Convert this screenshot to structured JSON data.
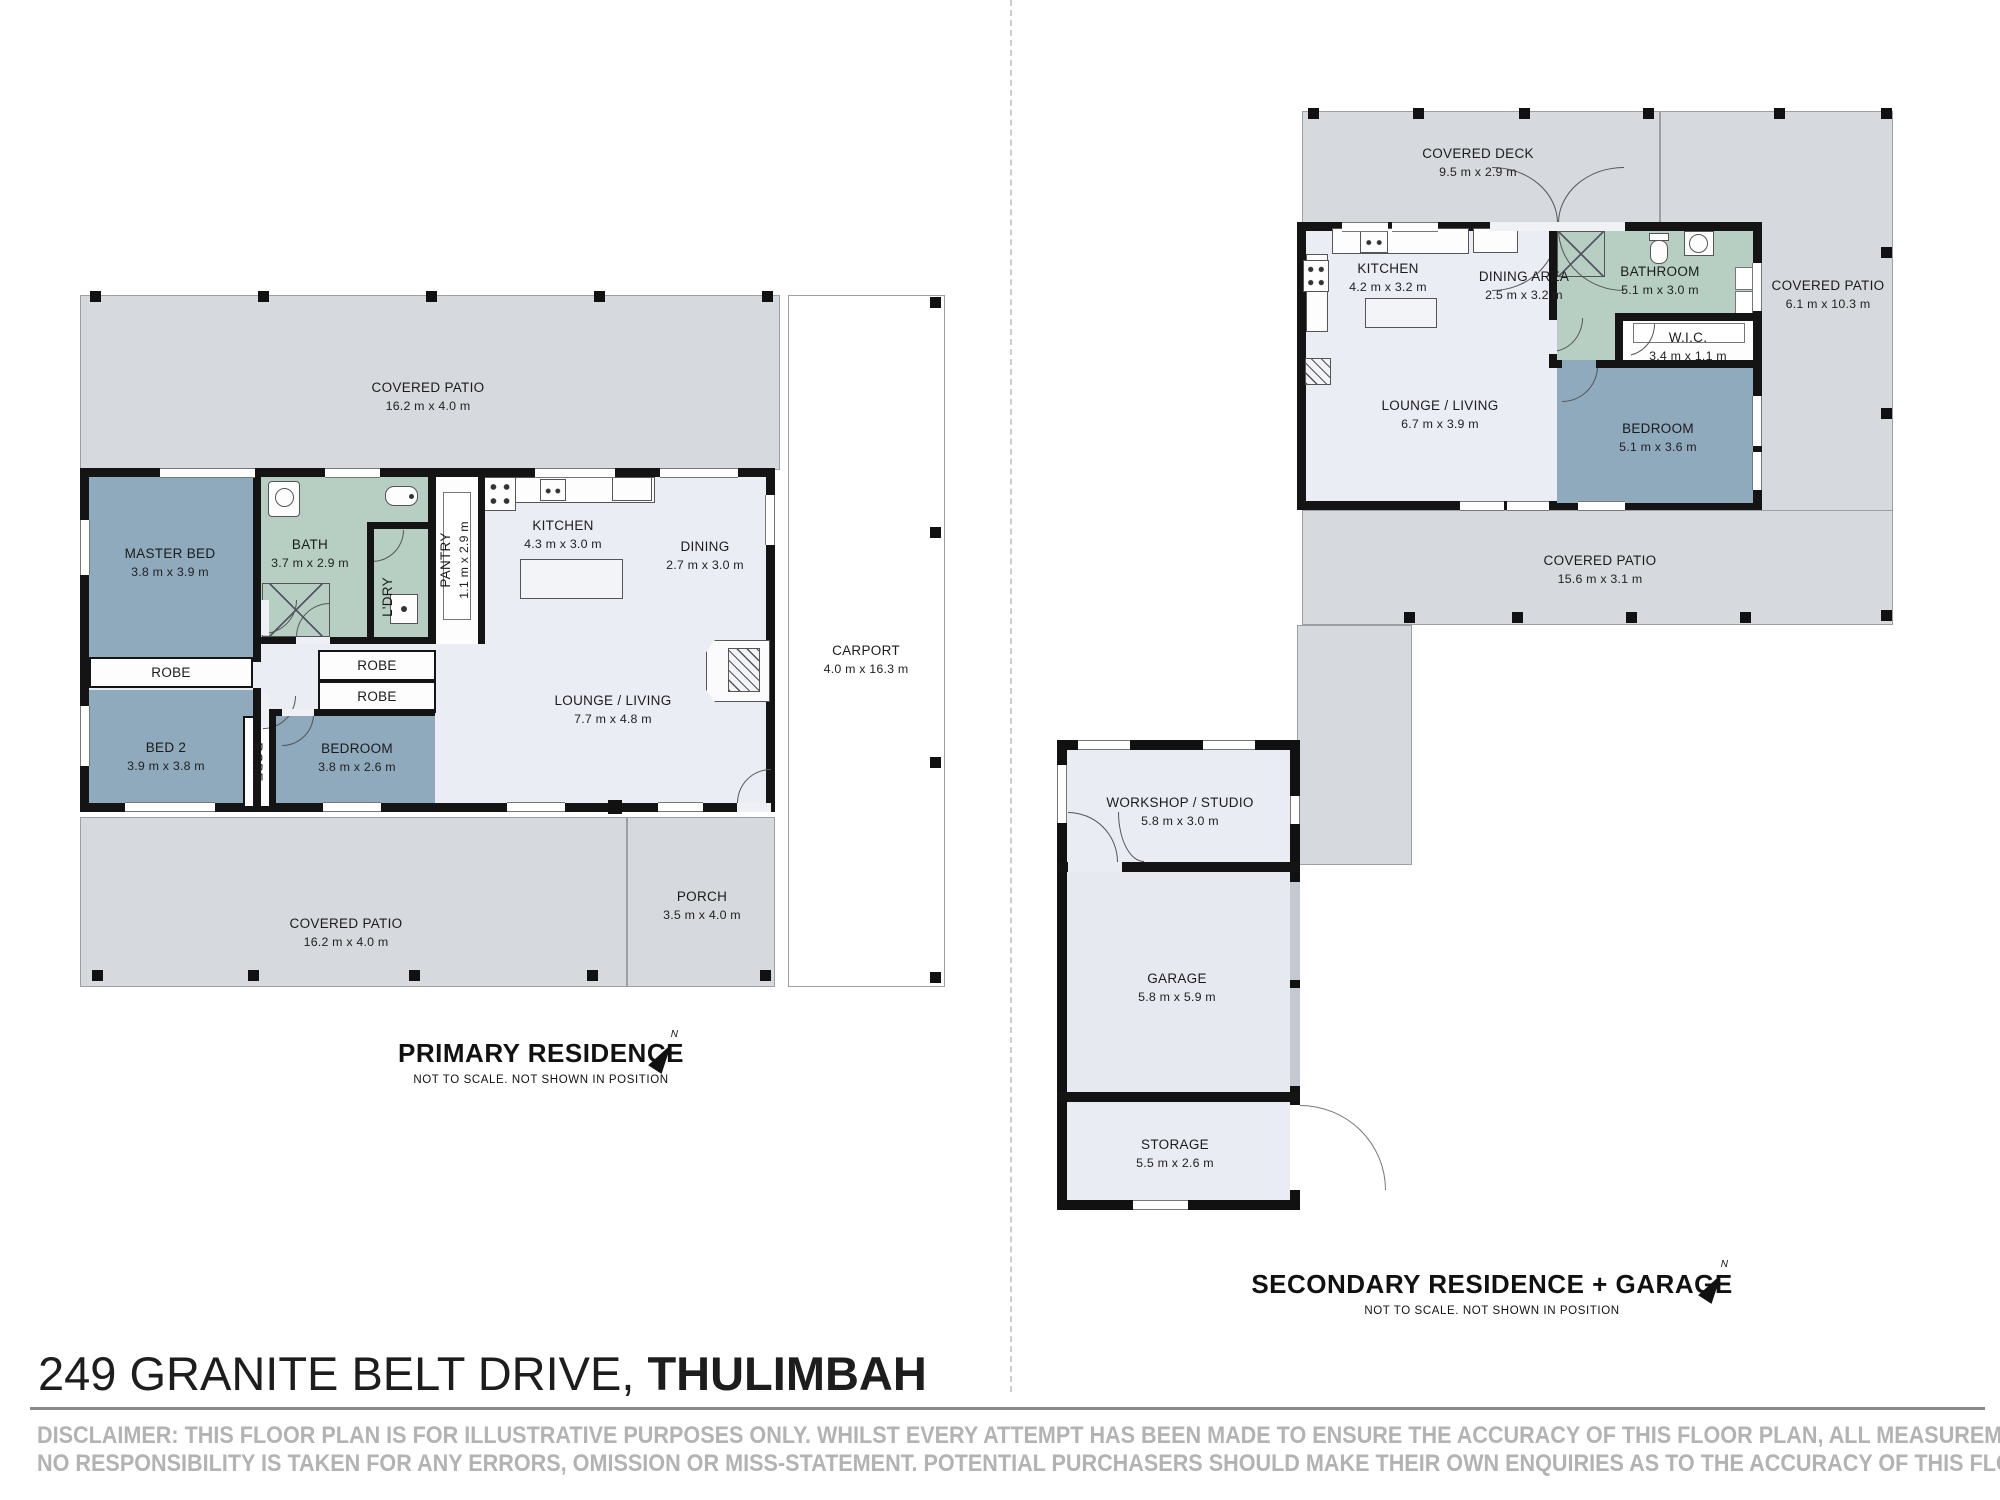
{
  "title": {
    "address": "249 GRANITE BELT DRIVE, ",
    "suburb": "THULIMBAH"
  },
  "disclaimer": {
    "line1": "DISCLAIMER: THIS FLOOR PLAN IS FOR ILLUSTRATIVE PURPOSES ONLY. WHILST EVERY ATTEMPT HAS BEEN MADE TO ENSURE THE ACCURACY OF THIS FLOOR PLAN, ALL MEASUREMENTS ARE APPROXIMATE ONLY.",
    "line2": "NO RESPONSIBILITY IS TAKEN FOR ANY ERRORS, OMISSION OR MISS-STATEMENT. POTENTIAL PURCHASERS SHOULD MAKE THEIR OWN ENQUIRIES AS TO THE ACCURACY OF THIS FLOOR PLAN."
  },
  "captions": {
    "primary": {
      "title": "PRIMARY RESIDENCE",
      "subtitle": "NOT TO SCALE. NOT SHOWN IN POSITION",
      "north": "N"
    },
    "secondary": {
      "title": "SECONDARY RESIDENCE + GARAGE",
      "subtitle": "NOT TO SCALE. NOT SHOWN IN POSITION",
      "north": "N"
    }
  },
  "primary": {
    "covered_patio_top": {
      "name": "COVERED PATIO",
      "dims": "16.2 m x 4.0 m"
    },
    "carport": {
      "name": "CARPORT",
      "dims": "4.0 m x 16.3 m"
    },
    "covered_patio_bottom": {
      "name": "COVERED PATIO",
      "dims": "16.2 m x 4.0 m"
    },
    "porch": {
      "name": "PORCH",
      "dims": "3.5 m x 4.0 m"
    },
    "master_bed": {
      "name": "MASTER BED",
      "dims": "3.8 m x 3.9 m"
    },
    "bath": {
      "name": "BATH",
      "dims": "3.7 m x 2.9 m"
    },
    "ldry": {
      "name": "L'DRY"
    },
    "pantry": {
      "name": "PANTRY",
      "dims": "1.1 m x 2.9 m"
    },
    "kitchen": {
      "name": "KITCHEN",
      "dims": "4.3 m x 3.0 m"
    },
    "dining": {
      "name": "DINING",
      "dims": "2.7 m x 3.0 m"
    },
    "robe_master": {
      "name": "ROBE"
    },
    "bed2": {
      "name": "BED 2",
      "dims": "3.9 m x 3.8 m"
    },
    "robe_a": {
      "name": "ROBE"
    },
    "robe_b": {
      "name": "ROBE"
    },
    "robe_vertical": {
      "name": "ROBE"
    },
    "bedroom": {
      "name": "BEDROOM",
      "dims": "3.8 m x 2.6 m"
    },
    "lounge": {
      "name": "LOUNGE / LIVING",
      "dims": "7.7 m x 4.8 m"
    }
  },
  "secondary": {
    "covered_deck": {
      "name": "COVERED DECK",
      "dims": "9.5 m x 2.9 m"
    },
    "covered_patio_right": {
      "name": "COVERED PATIO",
      "dims": "6.1 m x 10.3 m"
    },
    "covered_patio_bottom": {
      "name": "COVERED PATIO",
      "dims": "15.6 m x 3.1 m"
    },
    "kitchen": {
      "name": "KITCHEN",
      "dims": "4.2 m x 3.2 m"
    },
    "dining_area": {
      "name": "DINING AREA",
      "dims": "2.5 m x 3.2 m"
    },
    "lounge": {
      "name": "LOUNGE / LIVING",
      "dims": "6.7 m x 3.9 m"
    },
    "bathroom": {
      "name": "BATHROOM",
      "dims": "5.1 m x 3.0 m"
    },
    "wic": {
      "name": "W.I.C.",
      "dims": "3.4 m x 1.1 m"
    },
    "bedroom": {
      "name": "BEDROOM",
      "dims": "5.1 m x 3.6 m"
    },
    "workshop": {
      "name": "WORKSHOP / STUDIO",
      "dims": "5.8 m x 3.0 m"
    },
    "garage": {
      "name": "GARAGE",
      "dims": "5.8 m x 5.9 m"
    },
    "storage": {
      "name": "STORAGE",
      "dims": "5.5 m x 2.6 m"
    }
  },
  "colors": {
    "patio_gray": "#d6d9dd",
    "floor_light": "#eaedf4",
    "room_blue": "#8fa9bd",
    "room_green": "#b7cfc2",
    "wall_black": "#141414",
    "disclaimer_gray": "#b3b3b3"
  }
}
